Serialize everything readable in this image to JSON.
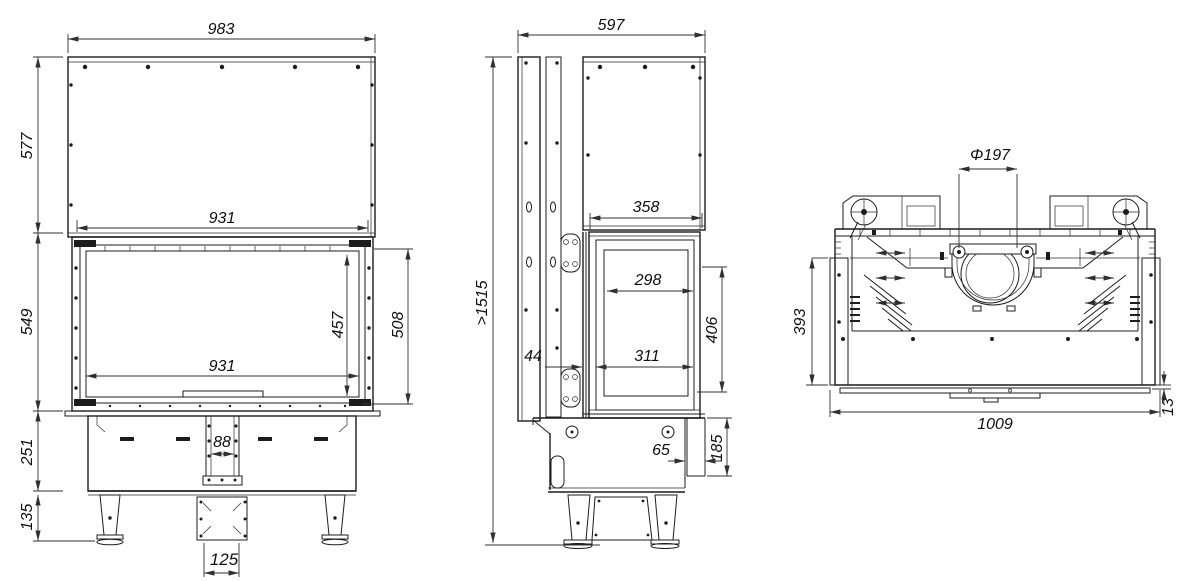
{
  "views": {
    "front": {
      "dims": {
        "overall_width": "983",
        "hood_height": "577",
        "opening_width_top": "931",
        "body_height": "549",
        "glass_width": "931",
        "glass_height": "457",
        "door_height": "508",
        "plinth_height": "251",
        "channel_width": "88",
        "legs_height": "135",
        "duct_width": "125"
      }
    },
    "side": {
      "dims": {
        "overall_depth": "597",
        "min_install_height": ">1515",
        "hood_depth": "358",
        "glass_depth": "298",
        "door_offset": "44",
        "opening_depth": "311",
        "glass_height": "406",
        "step_depth": "65",
        "plinth_height": "185"
      }
    },
    "top": {
      "dims": {
        "flue_diameter": "Φ197",
        "body_depth": "393",
        "overall_width": "1009",
        "front_lip": "13"
      }
    }
  },
  "colors": {
    "line": "#1c1c1c",
    "text": "#101010",
    "background": "#ffffff"
  }
}
